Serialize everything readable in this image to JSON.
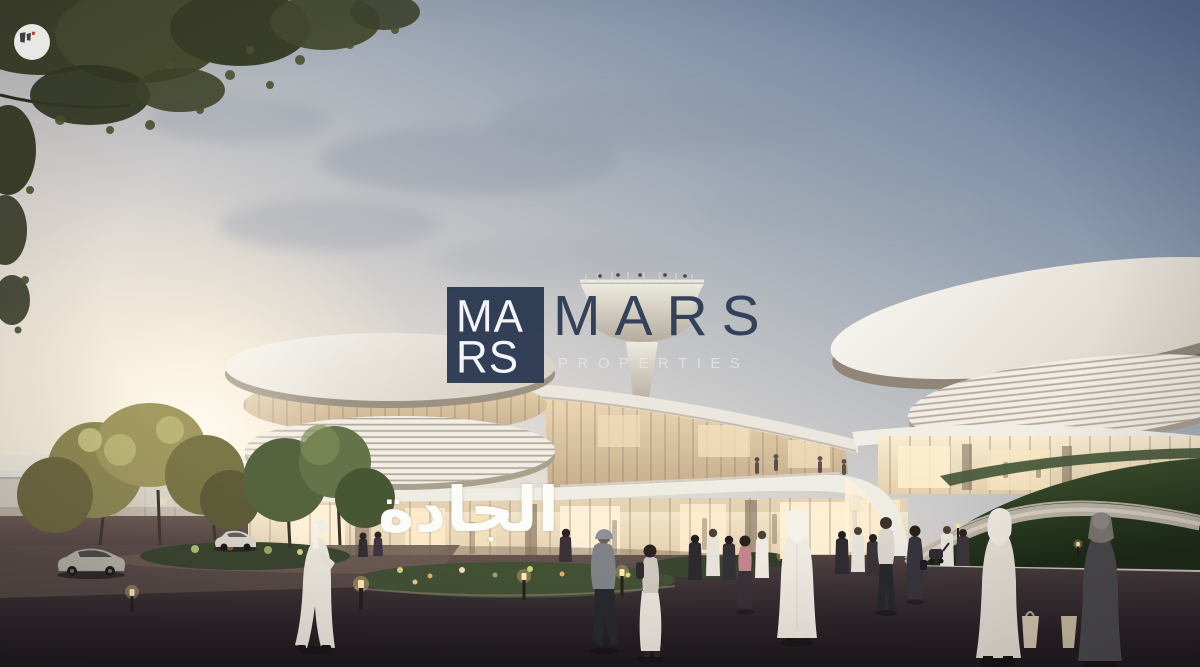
{
  "watermark_badge": {
    "icon": "w-monogram-icon",
    "background": "#f7f6f3",
    "mark_color": "#3b4046",
    "accent_dot_color": "#c23b32"
  },
  "mars_logo": {
    "monogram_line1": "MA",
    "monogram_line2": "RS",
    "monogram_bg": "#2d3b53",
    "monogram_text_color": "#f4f6f9",
    "wordmark": "MARS",
    "wordmark_color": "#2f3e57",
    "subtitle": "PROPERTIES",
    "subtitle_color": "rgba(228,231,236,0.8)"
  },
  "building_sign": {
    "text": "الجادة",
    "color": "#fcfcf9"
  },
  "scene_colors": {
    "sky_top": "#566d93",
    "sky_horizon": "#f7f0e1",
    "sun_glow": "#fffef8",
    "building_white": "#f2eee6",
    "glass_warm": "#f3e0ba",
    "grass_dark": "#2c3f22",
    "pavement": "#2a2328",
    "foliage": "#3d422b"
  }
}
